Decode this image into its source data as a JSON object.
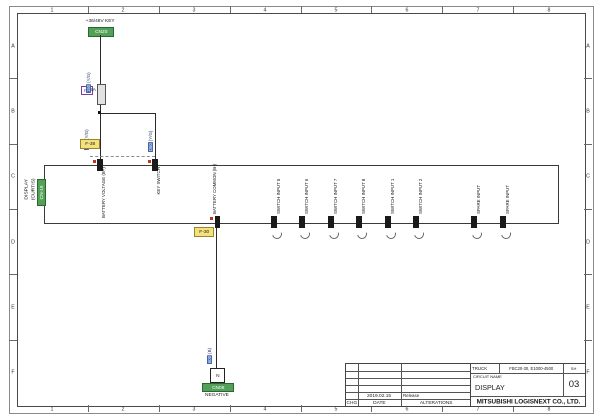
{
  "frame": {
    "cols": [
      "1",
      "2",
      "3",
      "4",
      "5",
      "6",
      "7",
      "8"
    ],
    "rows": [
      "A",
      "B",
      "C",
      "D",
      "E",
      "F"
    ]
  },
  "source": {
    "label": "+36/48V KEY",
    "ref": "CN20"
  },
  "fuse": {
    "id": "F6",
    "rating": "5A"
  },
  "wire_labels": {
    "key": {
      "num": "150",
      "color": "(Y/G)"
    },
    "battery_branch": {
      "num": "150",
      "color": "(Y/G)"
    },
    "key_branch": {
      "num": "D50",
      "color": "(Y/G)"
    },
    "negative": {
      "num": "600",
      "color": "(B)"
    }
  },
  "ref_links": {
    "f38": "F-38",
    "f30": "F-30"
  },
  "display_box": {
    "title": "DISPLAY",
    "subtitle": "(CURTIS)",
    "ref": "CN-19",
    "top_pins": [
      {
        "label": "BATTERY VOLTAGE (B+)"
      },
      {
        "label": "KEY SWITCH"
      }
    ],
    "common_pin": {
      "label": "BATTERY COMMON (B-)"
    },
    "bottom_pins": [
      {
        "label": "SWITCH INPUT 5"
      },
      {
        "label": "SWITCH INPUT 6"
      },
      {
        "label": "SWITCH INPUT 7"
      },
      {
        "label": "SWITCH INPUT 8"
      },
      {
        "label": "SWITCH INPUT 1"
      },
      {
        "label": "SWITCH INPUT 2"
      },
      {
        "label": "SPARE INPUT"
      },
      {
        "label": "SPARE INPUT"
      }
    ]
  },
  "negative_terminal": {
    "symbol": "N",
    "ref": "CN06",
    "label": "NEGATIVE"
  },
  "title_block": {
    "truck_label": "TRUCK",
    "truck_value": "FBC20-30, E1000-4500",
    "sh_label": "SH",
    "sheet_no": "03",
    "circuit_name_label": "CIRCUIT NAME",
    "circuit_name": "DISPLAY",
    "company": "MITSUBISHI LOGISNEXT CO., LTD.",
    "chg_label": "CHG",
    "date_label": "DATE",
    "alterations_label": "ALTERATIONS",
    "rev_date": "2019.02.15",
    "rev_note": "Release"
  },
  "colors": {
    "connector_ref_green": "#54a058",
    "wire_label_blue": "#3f62ad",
    "link_yellow": "#f2e17c",
    "fuse_purple": "#7a3fa0",
    "pin_mark_red": "#c23320"
  }
}
